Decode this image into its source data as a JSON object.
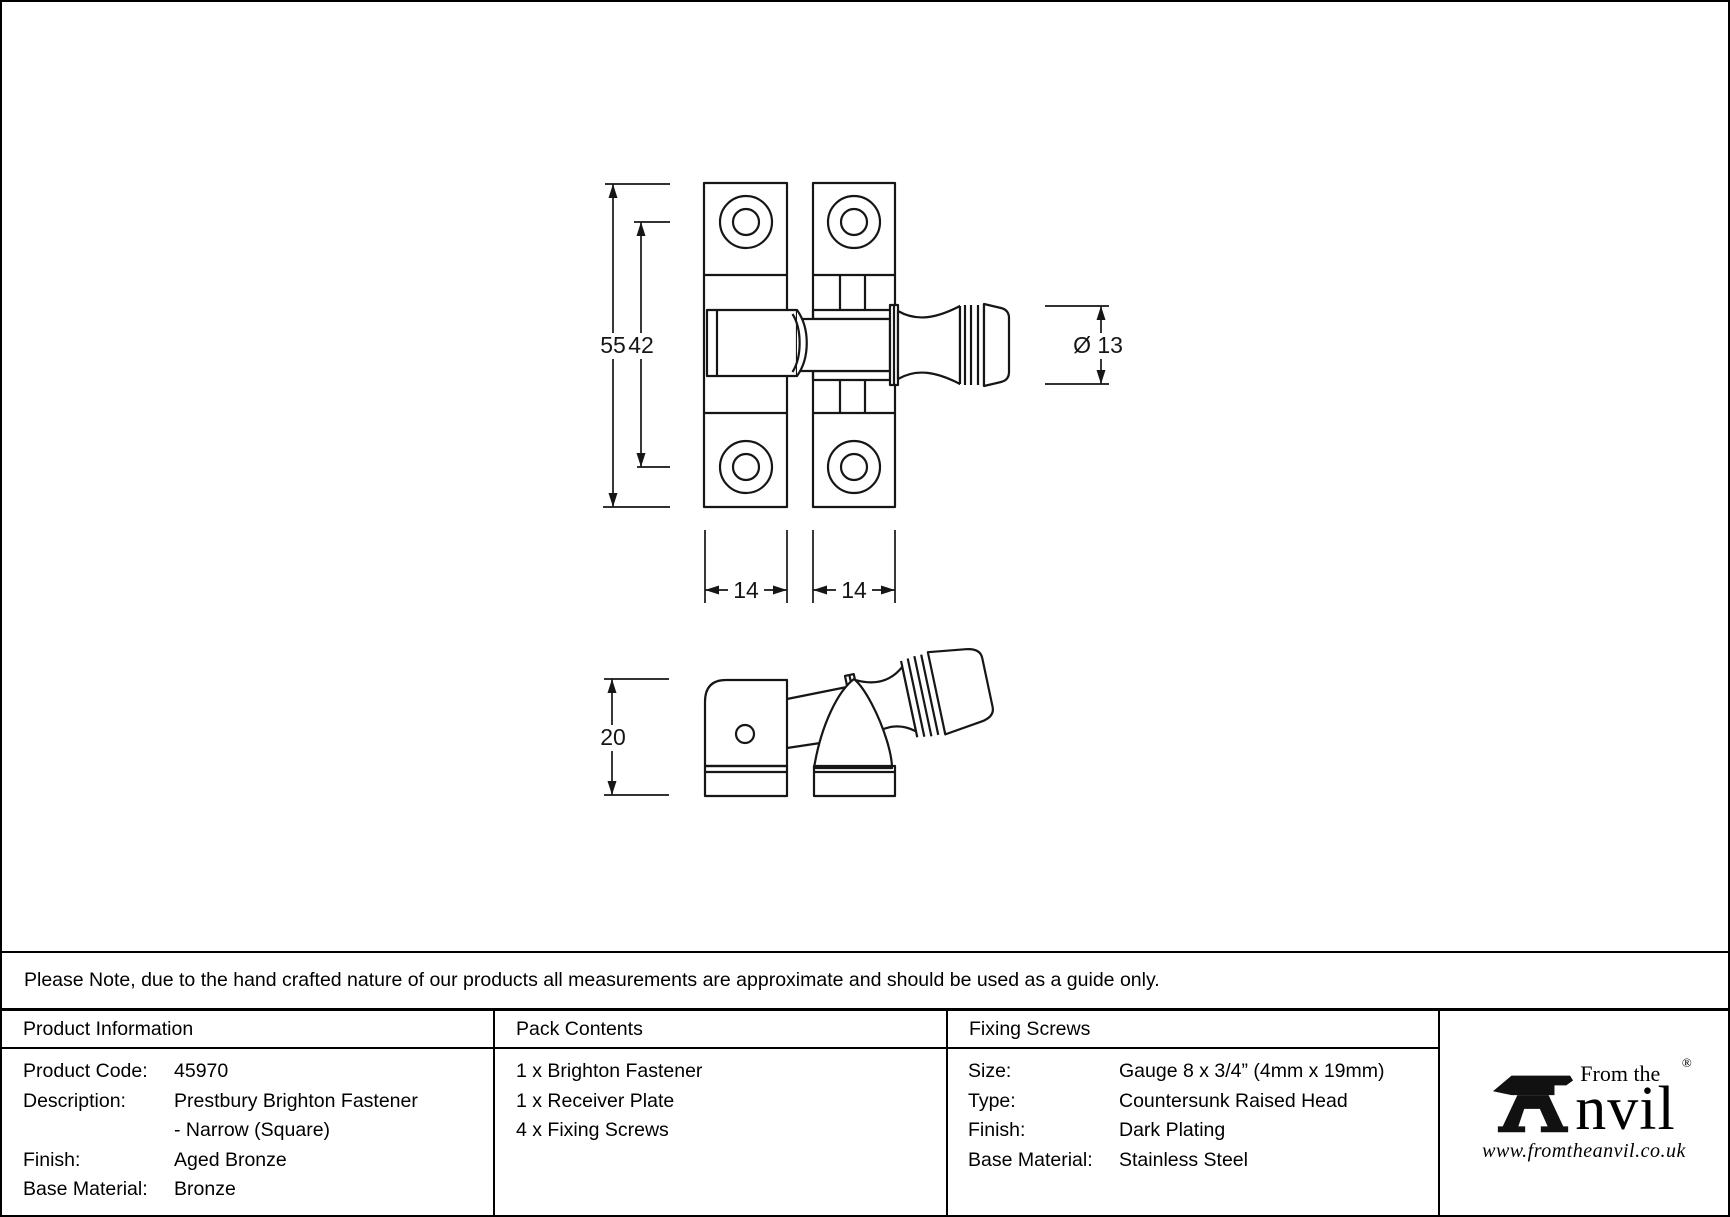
{
  "notice": "Please Note, due to the hand crafted nature of our products all measurements are approximate and should be used as a guide only.",
  "diagram": {
    "front_view": {
      "overall_height": "55",
      "hole_spacing": "42",
      "knob_diameter": "Ø 13",
      "left_plate_width": "14",
      "right_plate_width": "14"
    },
    "side_view": {
      "depth": "20"
    }
  },
  "table": {
    "product_information": {
      "header": "Product Information",
      "rows": [
        {
          "label": "Product Code:",
          "value": "45970"
        },
        {
          "label": "Description:",
          "value": "Prestbury Brighton Fastener"
        },
        {
          "label": "",
          "value": "- Narrow (Square)"
        },
        {
          "label": "Finish:",
          "value": "Aged Bronze"
        },
        {
          "label": "Base Material:",
          "value": "Bronze"
        }
      ]
    },
    "pack_contents": {
      "header": "Pack Contents",
      "items": [
        "1 x Brighton Fastener",
        "1 x Receiver Plate",
        "4 x Fixing Screws"
      ]
    },
    "fixing_screws": {
      "header": "Fixing Screws",
      "rows": [
        {
          "label": "Size:",
          "value": "Gauge 8 x 3/4” (4mm x 19mm)"
        },
        {
          "label": "Type:",
          "value": "Countersunk Raised Head"
        },
        {
          "label": "Finish:",
          "value": "Dark Plating"
        },
        {
          "label": "Base Material:",
          "value": "Stainless Steel"
        }
      ]
    }
  },
  "logo": {
    "tagline": "From the",
    "wordmark_rest": "nvil",
    "registered_mark": "®",
    "website": "www.fromtheanvil.co.uk"
  }
}
